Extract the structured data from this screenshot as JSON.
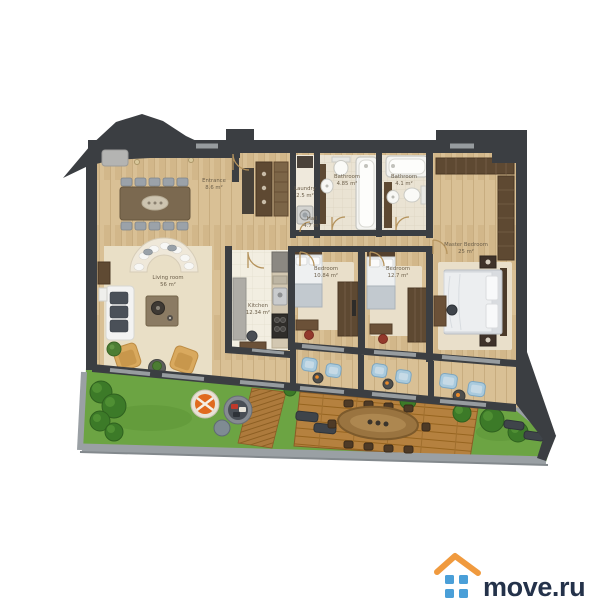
{
  "plan": {
    "type": "apartment-floor-plan",
    "rooms": [
      {
        "id": "living-room",
        "name": "Living room",
        "area": "56 m²"
      },
      {
        "id": "entrance",
        "name": "Entrance",
        "area": "8.6 m²"
      },
      {
        "id": "hall",
        "name": "Hall",
        "area": "4.7 m²"
      },
      {
        "id": "laundry",
        "name": "Laundry",
        "area": "2.5 m²"
      },
      {
        "id": "bathroom-1",
        "name": "Bathroom",
        "area": "4.85 m²"
      },
      {
        "id": "bathroom-2",
        "name": "Bathroom",
        "area": "4.1 m²"
      },
      {
        "id": "kitchen",
        "name": "Kitchen",
        "area": "12.34 m²"
      },
      {
        "id": "bedroom-1",
        "name": "Bedroom",
        "area": "10.84 m²"
      },
      {
        "id": "bedroom-2",
        "name": "Bedroom",
        "area": "12.7 m²"
      },
      {
        "id": "master-bedroom",
        "name": "Master Bedroom",
        "area": "25 m²"
      }
    ],
    "colors": {
      "wall": "#3b3e42",
      "wood_floor": "#d9c095",
      "tile_floor": "#eae3d3",
      "rug": "#e9dfc6",
      "grass": "#6ca443",
      "deck": "#b5813f",
      "lounger_blue": "#a9cadd",
      "armchair_tan": "#d9a95e",
      "wardrobe_brown": "#5e4932"
    }
  },
  "branding": {
    "logo_text": "move.ru",
    "roof_color": "#f09a3e",
    "window_color": "#4a9fd8",
    "text_color": "#24324a"
  }
}
